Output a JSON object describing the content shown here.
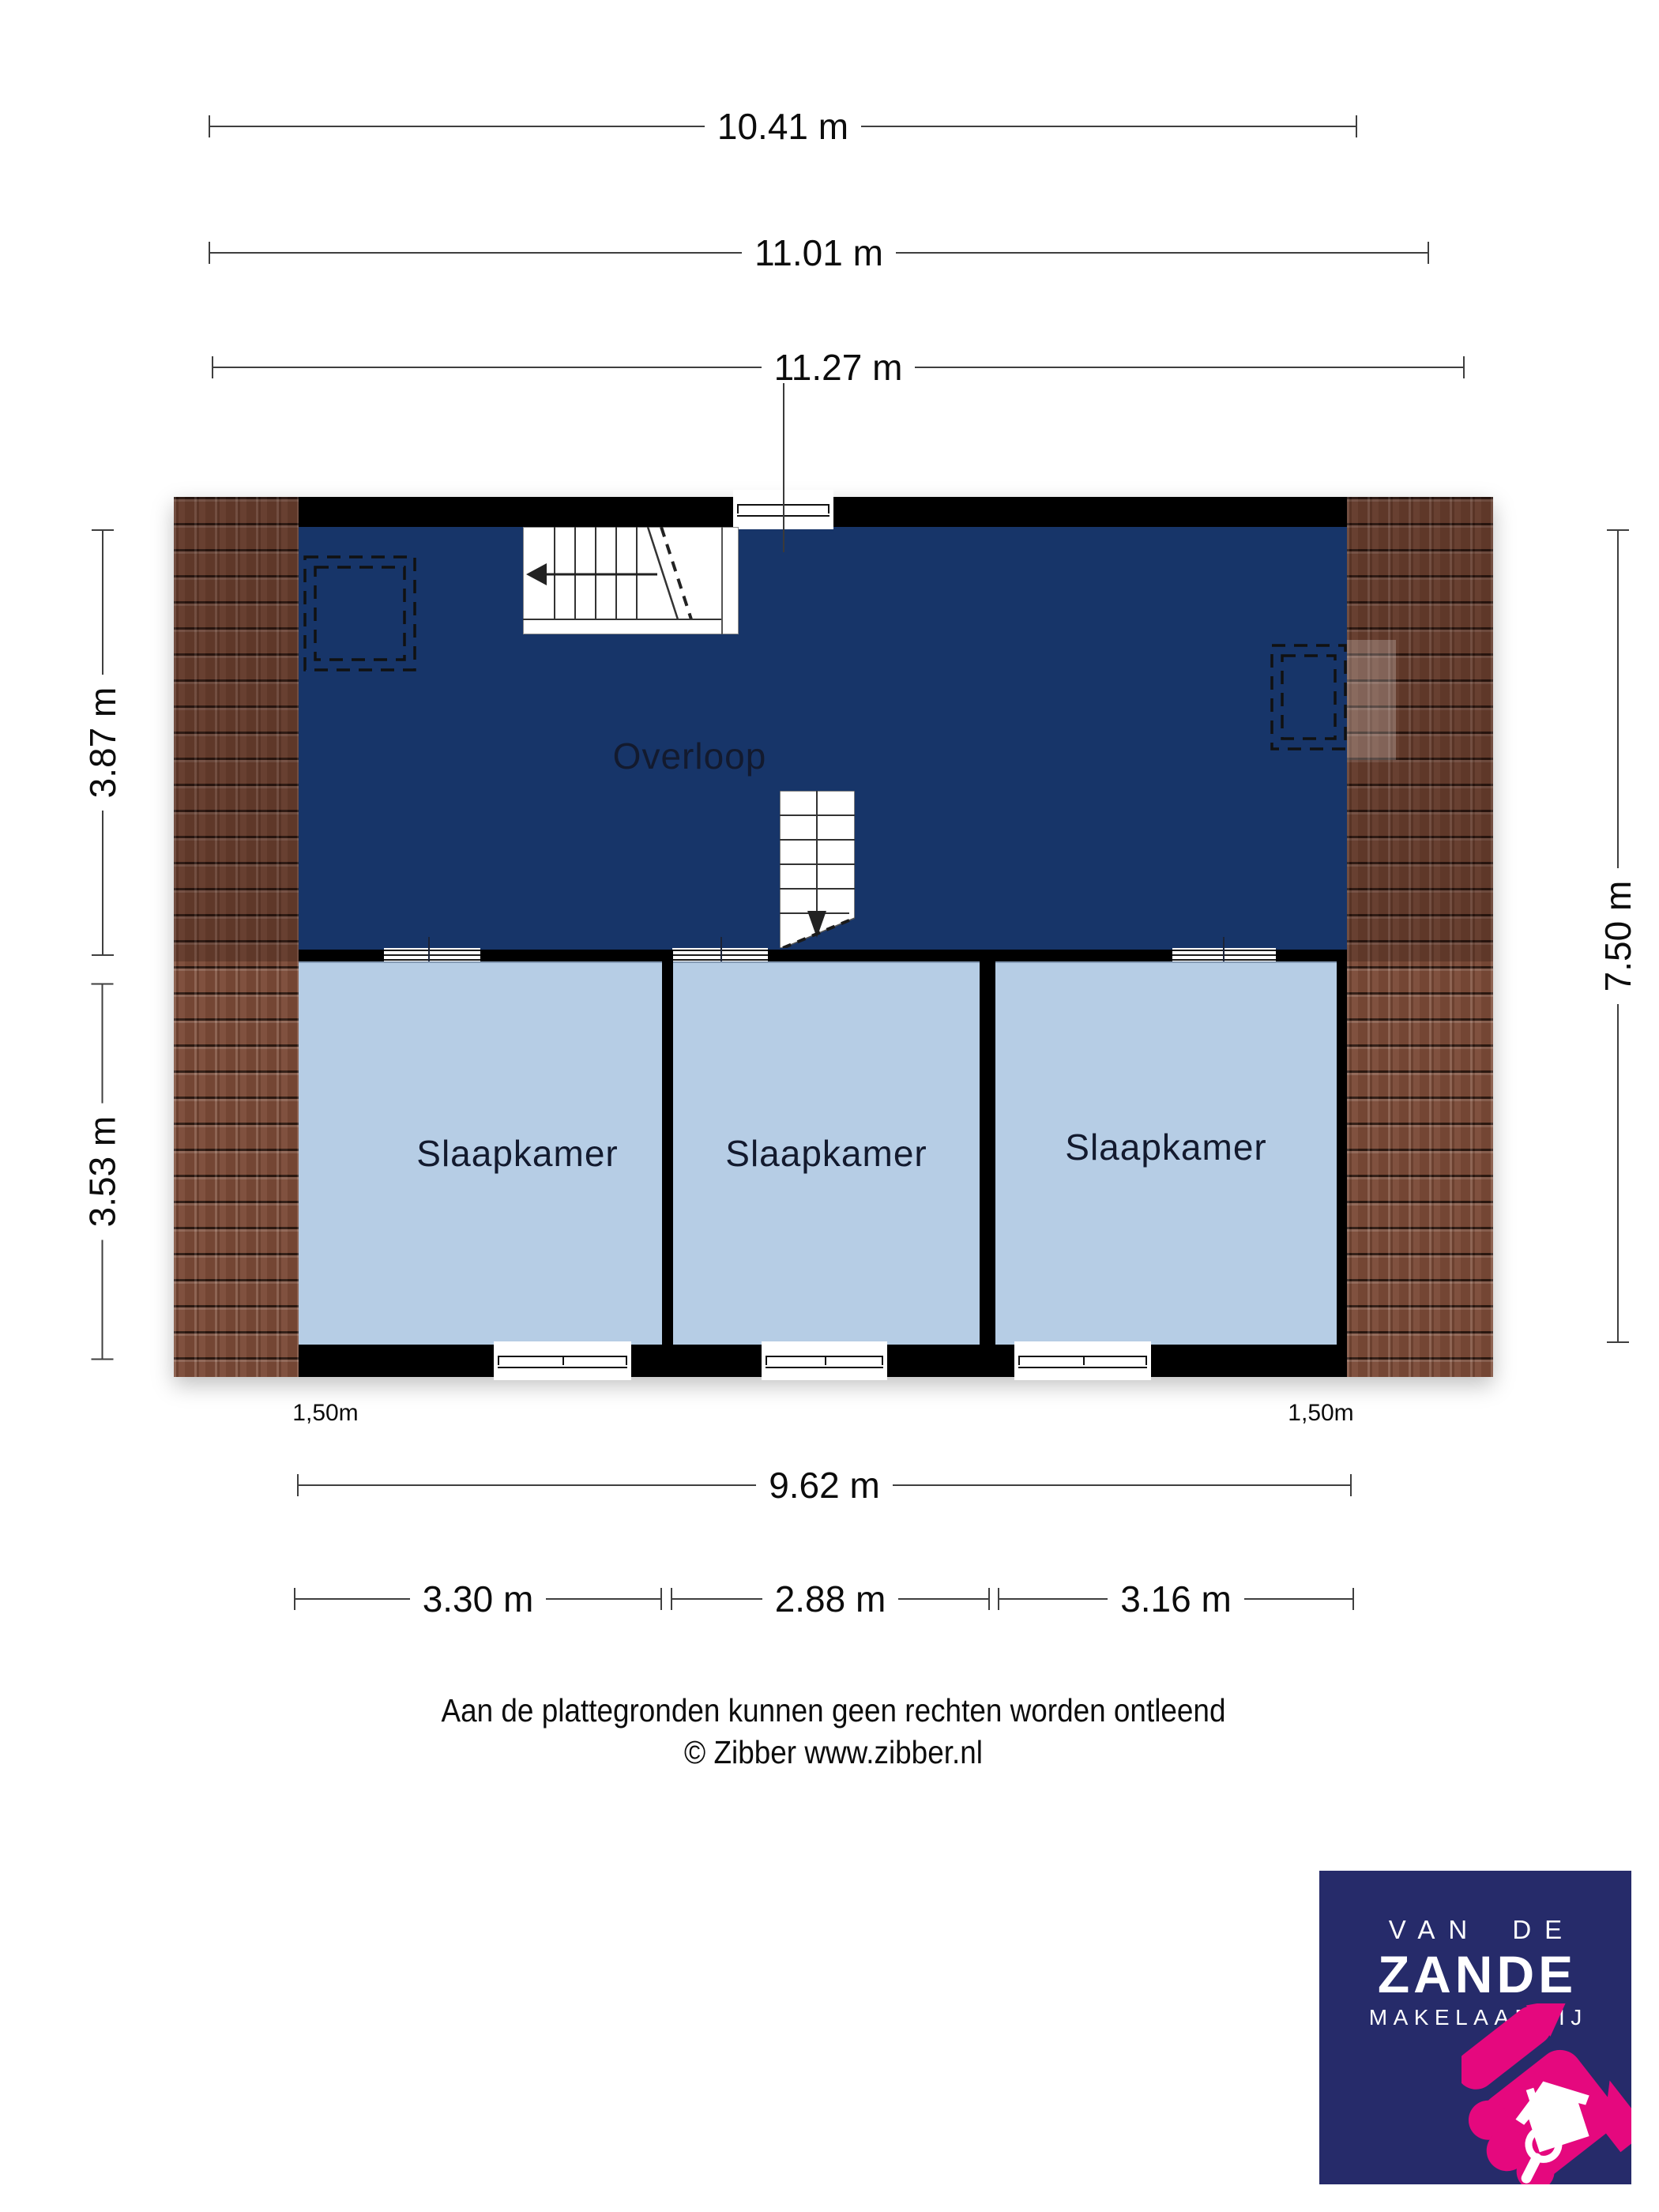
{
  "dimensions": {
    "width_inner": {
      "label": "10.41 m"
    },
    "width_mid": {
      "label": "11.01 m"
    },
    "width_outer": {
      "label": "11.27 m"
    },
    "depth_upper": {
      "label": "3.87 m"
    },
    "depth_lower": {
      "label": "3.53 m"
    },
    "depth_total": {
      "label": "7.50 m"
    },
    "width_floor": {
      "label": "9.62 m"
    },
    "room_widths": [
      {
        "label": "3.30 m"
      },
      {
        "label": "2.88 m"
      },
      {
        "label": "3.16 m"
      }
    ],
    "headroom_left": {
      "label": "1,50m"
    },
    "headroom_right": {
      "label": "1,50m"
    }
  },
  "rooms": {
    "landing": {
      "label": "Overloop"
    },
    "bedroom_1": {
      "label": "Slaapkamer"
    },
    "bedroom_2": {
      "label": "Slaapkamer"
    },
    "bedroom_3": {
      "label": "Slaapkamer"
    }
  },
  "footer": {
    "disclaimer": "Aan de plattegronden kunnen geen rechten worden ontleend",
    "credit": "© Zibber www.zibber.nl"
  },
  "logo": {
    "line_top": "VAN DE",
    "line_main": "ZANDE",
    "line_sub": "MAKELAARDIJ"
  },
  "colors": {
    "landing_fill": "#173569",
    "bedroom_fill": "#b6cde5",
    "wall": "#000000",
    "roof_tile": "#7b4a37",
    "logo_bg": "#262b6a",
    "logo_accent": "#e5087e"
  }
}
